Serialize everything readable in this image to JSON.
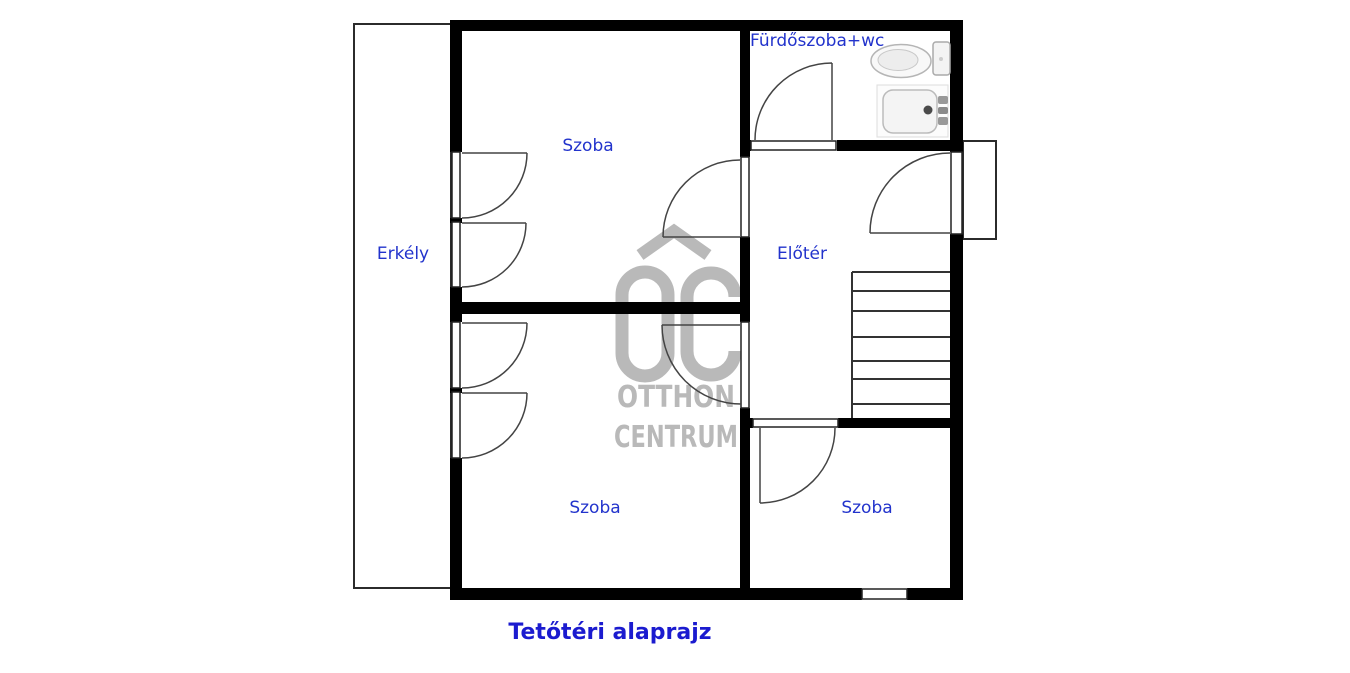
{
  "plan": {
    "title": "Tetőtéri alaprajz",
    "rooms": [
      {
        "id": "szoba-top",
        "label": "Szoba"
      },
      {
        "id": "erkely",
        "label": "Erkély"
      },
      {
        "id": "furdoszoba-wc",
        "label": "Fürdőszoba+wc"
      },
      {
        "id": "eloter",
        "label": "Előtér"
      },
      {
        "id": "szoba-bottom-left",
        "label": "Szoba"
      },
      {
        "id": "szoba-bottom-right",
        "label": "Szoba"
      }
    ],
    "features": {
      "stairs_steps": 7,
      "balcony_side": "left",
      "fixtures": [
        "toilet",
        "shower"
      ]
    }
  },
  "watermark": {
    "logo": "OC",
    "line1": "OTTHON",
    "line2": "CENTRUM"
  },
  "colors": {
    "wall_black": "#000000",
    "label_blue": "#2233cc",
    "title_blue": "#1b1bcf",
    "watermark_gray": "#b9b9b9"
  }
}
